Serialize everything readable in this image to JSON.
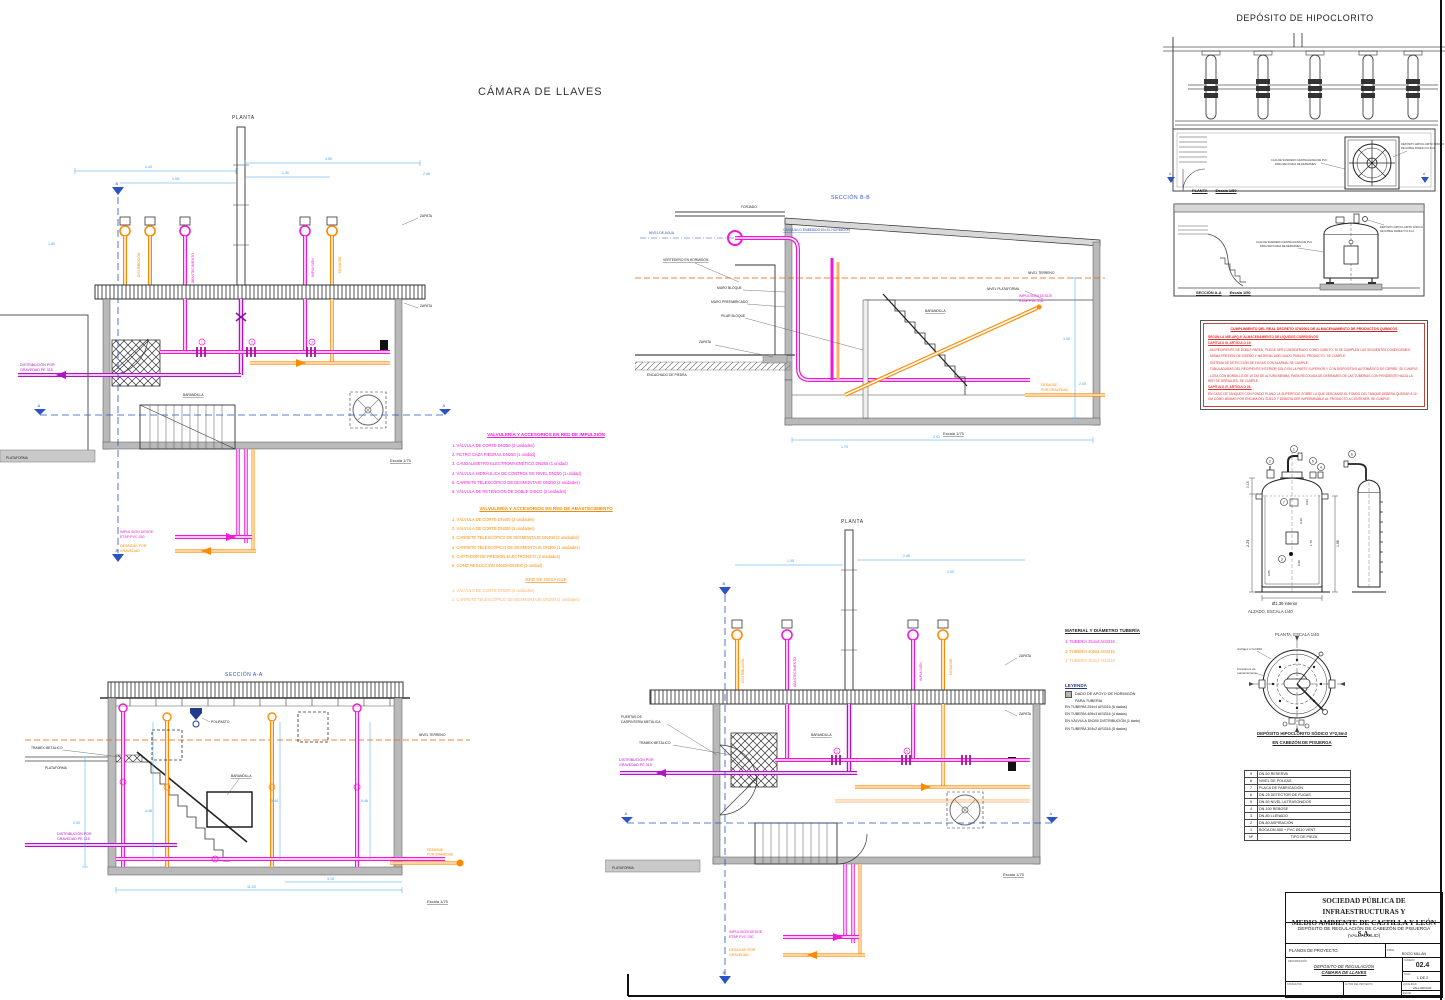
{
  "sheet": {
    "main_title": "CÁMARA DE LLAVES",
    "hipo_title": "DEPÓSITO DE HIPOCLORITO"
  },
  "callouts": [
    "1",
    "2",
    "3",
    "4",
    "5",
    "6",
    "7",
    "8",
    "9"
  ],
  "plan_top": {
    "title": "PLANTA",
    "escala": "Escala 1/75",
    "labels": {
      "zapata": "ZAPATA",
      "plataforma": "PLATAFORMA",
      "barandilla": "BARANDILLA",
      "dist1": "DISTRIBUCIÓN POR",
      "dist2": "GRAVEDAD PE 315",
      "imp1": "IMPULSIÓN DESDE",
      "imp2": "ETAP PVC 250",
      "des1": "DESAGÜE POR",
      "des2": "GRAVEDAD",
      "rot1": "DISTRIBUCIÓN",
      "rot2": "ABASTECIMIENTO",
      "rot3": "IMPULSIÓN",
      "rot4": "DESAGÜE",
      "ma": "A",
      "mb": "B"
    },
    "dims": [
      "2.40",
      "1.95",
      "4.50",
      "1.40",
      "2.46",
      "1.60"
    ]
  },
  "section_bb": {
    "title": "SECCIÓN B-B",
    "escala": "Escala 1/75",
    "labels": {
      "forjado": "FORJADO",
      "nivel_agua": "NIVEL DE AGUA",
      "vertedero": "VERTEDERO EN HORMIGÓN",
      "casquillo": "CASQUILLO EMBEBIDO EN EL HORMIGÓN",
      "muro_bloque": "MURO BLOQUE",
      "muro_pref": "MURO PREFABRICADO",
      "pilar": "PILAR BLOQUE",
      "zapata": "ZAPATA",
      "encachado": "ENCACHADO DE PIEDRA",
      "nivel_plat": "NIVEL PLATAFORMA",
      "nivel_terr": "NIVEL TERRENO",
      "barandilla": "BARANDILLA",
      "imp1": "IMPULSIÓN DESDE",
      "imp2": "ETAP PVC 250",
      "des1": "DESAGÜE",
      "des2": "POR GRAVEDAD"
    },
    "dims": [
      "3.40",
      "2.00",
      "2.91",
      "1.70"
    ]
  },
  "section_aa": {
    "title": "SECCIÓN A-A",
    "escala": "Escala 1/75",
    "labels": {
      "polipasto": "POLIPASTO",
      "tramex": "TRAMEX METÁLICO",
      "plataforma": "PLATAFORMA",
      "nivel_terr": "NIVEL TERRENO",
      "barandilla": "BARANDILLA",
      "dist1": "DISTRIBUCIÓN POR",
      "dist2": "GRAVEDAD PE 315",
      "des1": "DESAGÜE",
      "des2": "POR GRAVEDAD"
    },
    "dims": [
      "2.00",
      "4.48",
      "5.44",
      "5.46",
      "11.20",
      "3.15"
    ]
  },
  "plan_bottom": {
    "title": "PLANTA",
    "escala": "Escala 1/75",
    "labels": {
      "puertas1": "PUERTAS DE",
      "puertas2": "CARPINTERÍA METÁLICA",
      "tramex": "TRAMEX METÁLICO",
      "barandilla": "BARANDILLA",
      "zapata": "ZAPATA",
      "plataforma": "PLATAFORMA",
      "dist1": "DISTRIBUCIÓN POR",
      "dist2": "GRAVEDAD PE 315",
      "imp1": "IMPULSIÓN DESDE",
      "imp2": "ETAP PVC 250",
      "des1": "DESAGÜE POR",
      "des2": "GRAVEDAD",
      "rot1": "DISTRIBUCIÓN",
      "rot2": "ABASTECIMIENTO",
      "rot3": "IMPULSIÓN",
      "rot4": "DESAGÜE",
      "ma": "A",
      "mb": "B"
    },
    "dims": [
      "1.95",
      "2.46",
      "1.00"
    ]
  },
  "legend_impulsion": {
    "title": "VALVULERÍA Y ACCESORIOS EN RED DE IMPULSIÓN",
    "items": [
      "1. VÁLVULA DE CORTE DN250 (3 unidades)",
      "2. FILTRO CAZA PIEDRAS DN250 (1 unidad)",
      "3. CAUDALÍMETRO ELECTROMAGNÉTICO DN250 (1 unidad)",
      "4. VÁLVULA HIDRÁULICA DE CONTROL DE NIVEL DN250 (1 unidad)",
      "5. CARRETE TELESCÓPICO DE DESMONTAJE DN250 (2 unidades)",
      "6. VÁLVULA DE RETENCIÓN DE DOBLE DISCO (2 unidades)"
    ]
  },
  "legend_abastecimiento": {
    "title": "VALVULERÍA Y ACCESORIOS EN RED DE ABASTECIMIENTO",
    "items": [
      "1. VÁLVULA DE CORTE DN400 (2 unidades)",
      "2. VÁLVULA DE CORTE DN300 (1 unidades)",
      "3. CARRETE TELESCÓPIC0 DE DESMONTAJE DN400 (2 unidades)",
      "4. CARRETE TELESCÓPICO DE DESMONTAJE DN300 (1 unidades)",
      "5. CAPTADOR DE PRESIÓN ELECTRÓNICO (2 unidades)",
      "6. CONO REDUCCIÓN DN400-DN300 (1 unidad)"
    ]
  },
  "legend_desague": {
    "title": "RED DE DESAGÜE",
    "items": [
      "1. VÁLVULA DE CORTE DN200 (2 unidades)",
      "2. CARRETE TELESCÓPICO DE DESMONTAJE DN200 (2 unidades)"
    ]
  },
  "material": {
    "title": "MATERIAL Y DIÁMETRO TUBERÍA",
    "items": [
      "1. TUBERÍA 254x4 AISI316",
      "2. TUBERÍA 406x3 AISI316",
      "3. TUBERÍA 304x2 AISI316"
    ]
  },
  "leyenda": {
    "title": "LEYENDA",
    "dado1": "DADO DE APOYO DE HORMIGÓN",
    "dado2": "PARA TUBERÍA",
    "lines": [
      "EN TUBERÍA 254x4 AISI316 (6 dados)",
      "EN TUBERÍA 406x3 AISI316 (4 dados)",
      "EN VÁLVULA DN300 DISTRIBUCIÓN (1 dado)",
      "EN TUBERÍA 304x2 AISI316 (5 dados)"
    ]
  },
  "hipo": {
    "plan_label": "PLANTA",
    "plan_scale": "Escala 1/50",
    "section_label": "SECCIÓN A-A",
    "section_scale": "Escala 1/50",
    "note_sumidero1": "CAJA DE SUMIDERO CENTRALIZADA DE PVC",
    "note_sumidero2": "PARA RECOGIDA DE DERRAMES",
    "note_tank1": "DEPÓSITO HIPOCLORITO SÓDICO",
    "note_tank2": "DE DOBLE PARED V=2,5m3",
    "alzado_label": "ALZADO, ESCALA 1/40",
    "planta_label": "PLANTA, ESCALA 1/40",
    "anclajes": "Anclajes c/ tal Ø16",
    "cancamos1": "Cáncamos de",
    "cancamos2": "mantenimiento",
    "caption1": "DEPÓSITO HIPOCLORITO SÓDICO V=2,5m3",
    "caption2": "EN CABEZÓN DE PISUERGA",
    "marker_a": "A",
    "dims": {
      "d015": "0.15",
      "d229": "2.29",
      "d005": "0.05",
      "d030": "0.30",
      "d170": "1.70",
      "d198": "1.98",
      "d090": "0.90",
      "d003": "0.03",
      "diam": "Ø1.36  interior"
    }
  },
  "apq": {
    "title": "CUMPLIMIENTO DEL REAL DECRETO 379/2001 DE ALMACENAMIENTO DE PRODUCTOS QUÍMICOS",
    "lines": [
      "SEGÚN LA MIE-APQ-6 'ALMACENAMIENTO DE LÍQUIDOS CORROSIVOS'",
      "CAPÍTULO III, ARTÍCULO 19:",
      "- UN RECIPIENTE DE DOBLE PARED, PUEDE SER CONSIDERADO COMO CUBETO, SI SE CUMPLEN LAS SIGUIENTES CONDICIONES:",
      "- MISMA PRESIÓN DE DISEÑO Y MATERIAL ADECUADO PARA EL PRODUCTO. SE CUMPLE.",
      "- SISTEMA DE DETECCIÓN DE FUGAS CON ALARMA. SE CUMPLE.",
      "- TUBULADURAS DEL RECIPIENTE INTERIOR SOLO EN LA PARTE SUPERIOR Y CON DISPOSITIVO AUTOMÁTICO DE CIERRE. SE CUMPLE.",
      "- LOSA CON BORDILLO DE 10 CM DE ALTURA MÍNIMA, PARA RECOGIDA DE DERRAMES DE LAS TUBERÍAS CON PENDIENTE HACIA LA RED DE DRENAJES. SE CUMPLE.",
      "CAPÍTULO IV, ARTÍCULO 24:",
      "EN CASO DE TANQUES CON FONDO PLANO LA SUPERFICIE SOBRE LA QUE DESCANSE EL FONDO DEL TANQUE DEBERÁ QUEDAR A 10 CM COMO MÍNIMO POR ENCIMA DEL SUELO Y DEBERÁ SER IMPERMEABLE AL PRODUCTO A CONTENER. SE CUMPLE."
    ]
  },
  "parts_table": {
    "rows": [
      {
        "num": "9",
        "label": "DN-50 RESERVA"
      },
      {
        "num": "8",
        "label": "NIVEL DE POLEAS"
      },
      {
        "num": "7",
        "label": "PLACA DE FABRICACIÓN"
      },
      {
        "num": "6",
        "label": "DN-25 DETECTOR DE FUGAS"
      },
      {
        "num": "5",
        "label": "DN-50 NIVEL ULTRASONIDOS"
      },
      {
        "num": "4",
        "label": "DN-100 REBOSE"
      },
      {
        "num": "3",
        "label": "DN-80 LLENADO"
      },
      {
        "num": "2",
        "label": "DN-80 ASPIRACIÓN"
      },
      {
        "num": "1",
        "label": "BOCA DN-500 + PVC Ø110 VENT"
      }
    ],
    "footer_num": "Nº",
    "footer_label": "TIPO DE PIEZA"
  },
  "title_block": {
    "company1": "SOCIEDAD PÚBLICA DE INFRAESTRUCTURAS Y",
    "company2": "MEDIO AMBIENTE DE CASTILLA Y LEÓN S.A.",
    "project1": "DEPÓSITO DE REGULACIÓN DE CABEZÓN DE PISUERGA",
    "project2": "(VALLADOLID)",
    "phase": "PLANOS DE PROYECTO.",
    "firma_label": "FIRMA",
    "firma": "ROCÍO MILLÁN",
    "denom_label": "DENOMINACIÓN",
    "dwg1": "DEPÓSITO DE REGULACIÓN",
    "dwg2": "CÁMARA DE LLAVES",
    "numero_label": "NÚMERO",
    "numero": "02.4",
    "hoja_label": "HOJA",
    "hoja": "1 DE 2",
    "consultor_label": "CONSULTOR",
    "autor_label": "AUTOR DEL PROYECTO",
    "localidad_label": "LOCALIDAD",
    "localidad": "VALLADOLID",
    "fecha_label": "FECHA",
    "fecha": "MAYO 2022"
  },
  "colors": {
    "magenta": "#f316dd",
    "purple": "#b511c9",
    "orange": "#ff8a00",
    "peach": "#fdb36a",
    "dim_blue": "#3da0f0",
    "marker_blue": "#2b53c5",
    "alarm_red": "#e03030"
  }
}
